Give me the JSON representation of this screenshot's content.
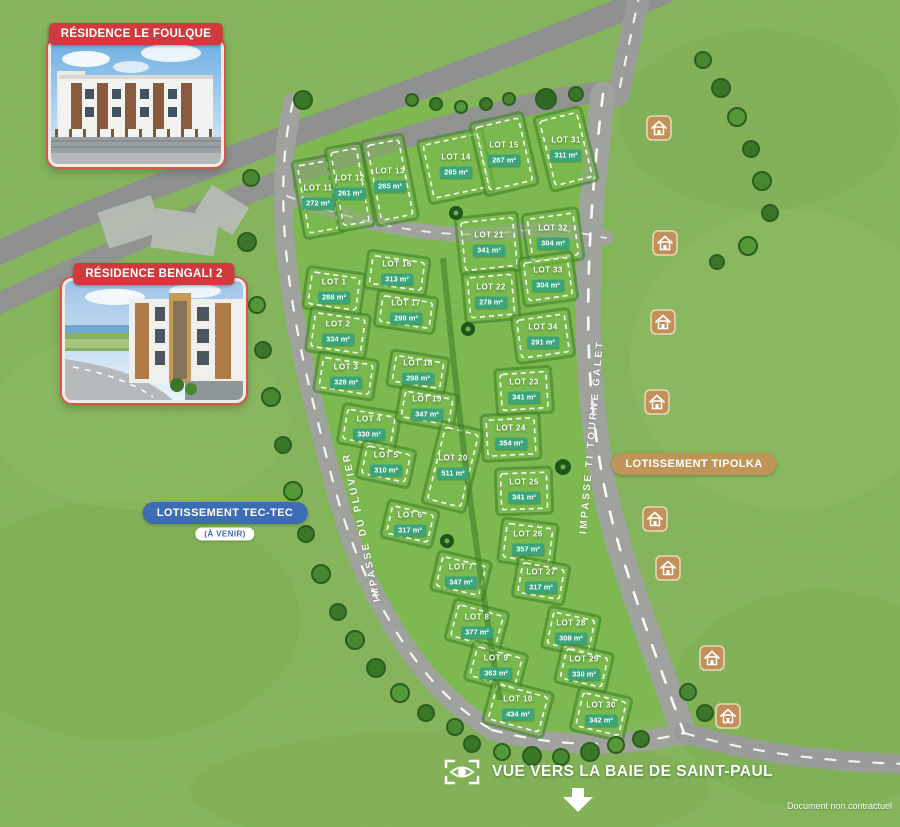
{
  "page": {
    "note": "Document non contractuel"
  },
  "residences": [
    {
      "name": "RÉSIDENCE LE FOULQUE"
    },
    {
      "name": "RÉSIDENCE BENGALI 2"
    }
  ],
  "developments": {
    "tec_tec": {
      "label": "LOTISSEMENT TEC-TEC",
      "status": "(À VENIR)"
    },
    "tipolka": {
      "label": "LOTISSEMENT TIPOLKA"
    }
  },
  "streets": [
    {
      "name": "IMPASSE DU PLUVIER"
    },
    {
      "name": "IMPASSE TI TOURNE GALET"
    }
  ],
  "view_marker": {
    "label": "VUE VERS LA BAIE DE SAINT-PAUL"
  },
  "colors": {
    "badge_red": "#d13a3c",
    "area_chip_green": "#3ba57a",
    "tec_tec_blue": "#3c6cb4",
    "tipolka_tan": "#bf9457",
    "grass": "#86b55c",
    "road_grey": "#a0a29e"
  },
  "lots": [
    {
      "id": "LOT 1",
      "area": "288 m²",
      "x": 334,
      "y": 291,
      "w": 58,
      "h": 42,
      "rot": 8
    },
    {
      "id": "LOT 2",
      "area": "334 m²",
      "x": 338,
      "y": 333,
      "w": 60,
      "h": 44,
      "rot": 8
    },
    {
      "id": "LOT 3",
      "area": "328 m²",
      "x": 346,
      "y": 376,
      "w": 60,
      "h": 40,
      "rot": 9
    },
    {
      "id": "LOT 4",
      "area": "330 m²",
      "x": 369,
      "y": 428,
      "w": 58,
      "h": 40,
      "rot": 10
    },
    {
      "id": "LOT 5",
      "area": "310 m²",
      "x": 386,
      "y": 464,
      "w": 54,
      "h": 38,
      "rot": 12
    },
    {
      "id": "LOT 6",
      "area": "317 m²",
      "x": 410,
      "y": 524,
      "w": 52,
      "h": 38,
      "rot": 13
    },
    {
      "id": "LOT 7",
      "area": "347 m²",
      "x": 461,
      "y": 576,
      "w": 54,
      "h": 40,
      "rot": 13
    },
    {
      "id": "LOT 8",
      "area": "377 m²",
      "x": 477,
      "y": 626,
      "w": 56,
      "h": 42,
      "rot": 15
    },
    {
      "id": "LOT 9",
      "area": "363 m²",
      "x": 496,
      "y": 667,
      "w": 56,
      "h": 40,
      "rot": 15
    },
    {
      "id": "LOT 10",
      "area": "434 m²",
      "x": 518,
      "y": 708,
      "w": 62,
      "h": 46,
      "rot": 15
    },
    {
      "id": "LOT 11",
      "area": "272 m²",
      "x": 318,
      "y": 197,
      "w": 40,
      "h": 78,
      "rot": -10
    },
    {
      "id": "LOT 12",
      "area": "261 m²",
      "x": 350,
      "y": 187,
      "w": 36,
      "h": 84,
      "rot": -10
    },
    {
      "id": "LOT 13",
      "area": "265 m²",
      "x": 390,
      "y": 180,
      "w": 42,
      "h": 86,
      "rot": -11
    },
    {
      "id": "LOT 14",
      "area": "295 m²",
      "x": 456,
      "y": 166,
      "w": 66,
      "h": 64,
      "rot": -12
    },
    {
      "id": "LOT 15",
      "area": "267 m²",
      "x": 504,
      "y": 154,
      "w": 54,
      "h": 74,
      "rot": -13
    },
    {
      "id": "LOT 16",
      "area": "313 m²",
      "x": 397,
      "y": 273,
      "w": 62,
      "h": 38,
      "rot": 8
    },
    {
      "id": "LOT 17",
      "area": "299 m²",
      "x": 406,
      "y": 312,
      "w": 60,
      "h": 36,
      "rot": 8
    },
    {
      "id": "LOT 18",
      "area": "298 m²",
      "x": 418,
      "y": 372,
      "w": 58,
      "h": 36,
      "rot": 9
    },
    {
      "id": "LOT 19",
      "area": "347 m²",
      "x": 427,
      "y": 408,
      "w": 58,
      "h": 36,
      "rot": 10
    },
    {
      "id": "LOT 20",
      "area": "511 m²",
      "x": 453,
      "y": 467,
      "w": 44,
      "h": 84,
      "rot": 14
    },
    {
      "id": "LOT 21",
      "area": "341 m²",
      "x": 489,
      "y": 244,
      "w": 62,
      "h": 58,
      "rot": -6
    },
    {
      "id": "LOT 22",
      "area": "278 m²",
      "x": 491,
      "y": 296,
      "w": 54,
      "h": 50,
      "rot": -5
    },
    {
      "id": "LOT 23",
      "area": "341 m²",
      "x": 524,
      "y": 391,
      "w": 56,
      "h": 46,
      "rot": -4
    },
    {
      "id": "LOT 24",
      "area": "354 m²",
      "x": 511,
      "y": 437,
      "w": 58,
      "h": 46,
      "rot": -3
    },
    {
      "id": "LOT 25",
      "area": "341 m²",
      "x": 524,
      "y": 491,
      "w": 56,
      "h": 46,
      "rot": -2
    },
    {
      "id": "LOT 26",
      "area": "357 m²",
      "x": 528,
      "y": 543,
      "w": 56,
      "h": 44,
      "rot": 7
    },
    {
      "id": "LOT 27",
      "area": "317 m²",
      "x": 541,
      "y": 581,
      "w": 52,
      "h": 40,
      "rot": 10
    },
    {
      "id": "LOT 28",
      "area": "308 m²",
      "x": 571,
      "y": 632,
      "w": 52,
      "h": 42,
      "rot": 12
    },
    {
      "id": "LOT 29",
      "area": "330 m²",
      "x": 584,
      "y": 668,
      "w": 52,
      "h": 40,
      "rot": 13
    },
    {
      "id": "LOT 30",
      "area": "342 m²",
      "x": 601,
      "y": 714,
      "w": 54,
      "h": 44,
      "rot": 13
    },
    {
      "id": "LOT 31",
      "area": "311 m²",
      "x": 566,
      "y": 149,
      "w": 48,
      "h": 76,
      "rot": -14
    },
    {
      "id": "LOT 32",
      "area": "304 m²",
      "x": 553,
      "y": 237,
      "w": 56,
      "h": 52,
      "rot": -8
    },
    {
      "id": "LOT 33",
      "area": "304 m²",
      "x": 548,
      "y": 279,
      "w": 54,
      "h": 48,
      "rot": -8
    },
    {
      "id": "LOT 34",
      "area": "291 m²",
      "x": 543,
      "y": 336,
      "w": 58,
      "h": 48,
      "rot": -8
    }
  ],
  "house_icons": [
    {
      "x": 659,
      "y": 128
    },
    {
      "x": 665,
      "y": 243
    },
    {
      "x": 663,
      "y": 322
    },
    {
      "x": 657,
      "y": 402
    },
    {
      "x": 655,
      "y": 519
    },
    {
      "x": 668,
      "y": 568
    },
    {
      "x": 712,
      "y": 658
    },
    {
      "x": 728,
      "y": 716
    }
  ]
}
